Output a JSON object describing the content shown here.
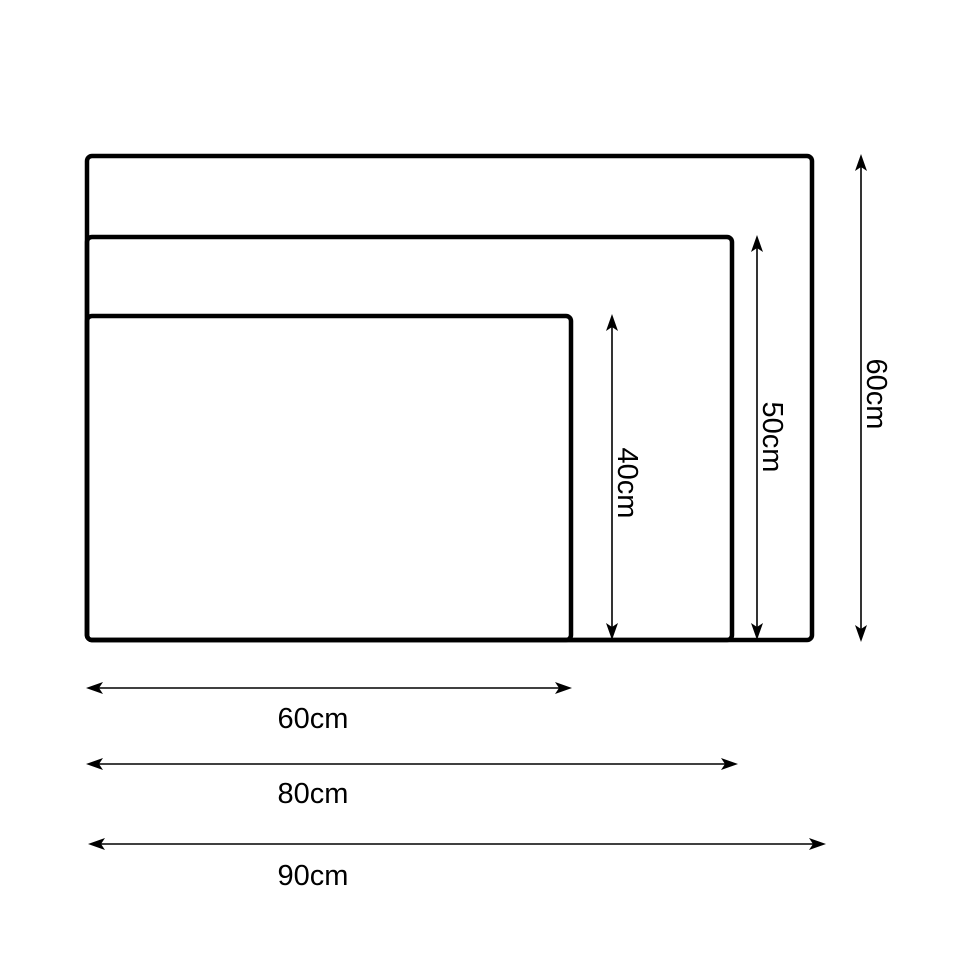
{
  "colors": {
    "line": "#000000",
    "background": "#ffffff",
    "text": "#000000"
  },
  "diagram": {
    "kind": "nested-rectangle-size-comparison",
    "unit": "cm",
    "sizes": [
      {
        "id": "large",
        "width": "90cm",
        "height": "60cm",
        "width_cm": 90,
        "height_cm": 60
      },
      {
        "id": "medium",
        "width": "80cm",
        "height": "50cm",
        "width_cm": 80,
        "height_cm": 50
      },
      {
        "id": "small",
        "width": "60cm",
        "height": "40cm",
        "width_cm": 60,
        "height_cm": 40
      }
    ]
  }
}
